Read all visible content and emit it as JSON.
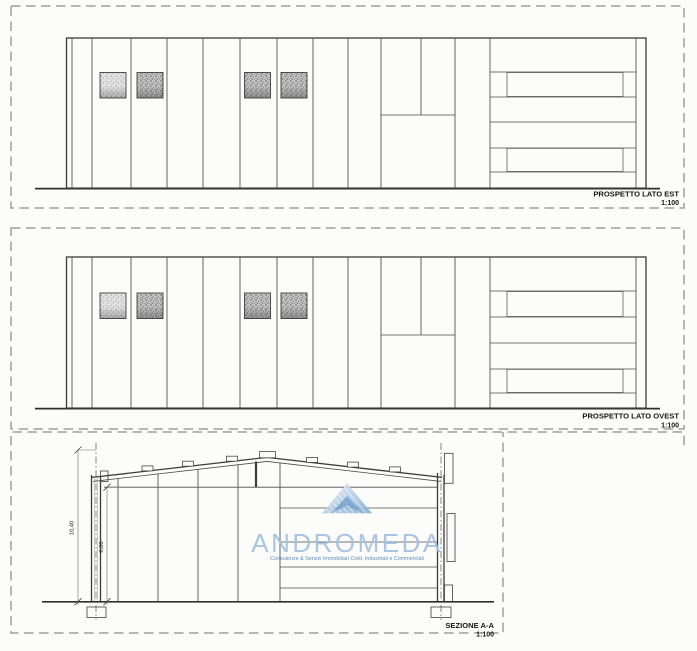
{
  "sheet": {
    "background_color": "#fcfcfb",
    "ink_color": "#4a4a4a",
    "frame_color": "#8d8d8d"
  },
  "panels": {
    "est": {
      "title": "PROSPETTO LATO EST",
      "scale": "1:100"
    },
    "ovest": {
      "title": "PROSPETTO LATO OVEST",
      "scale": "1:100"
    },
    "sezione": {
      "title": "SEZIONE A-A",
      "scale": "1:100"
    }
  },
  "section": {
    "dimensions": {
      "overall_height": "10,40",
      "eave_height": "8,00"
    }
  },
  "logo": {
    "name": "ANDROMEDA",
    "tagline": "Consulenze & Servizi Immobiliari Civili, Industriali e Commerciali",
    "text_color": "#a3c1e0",
    "tagline_color": "#5f8cb8",
    "triangle_color": "#7fa9d2"
  }
}
